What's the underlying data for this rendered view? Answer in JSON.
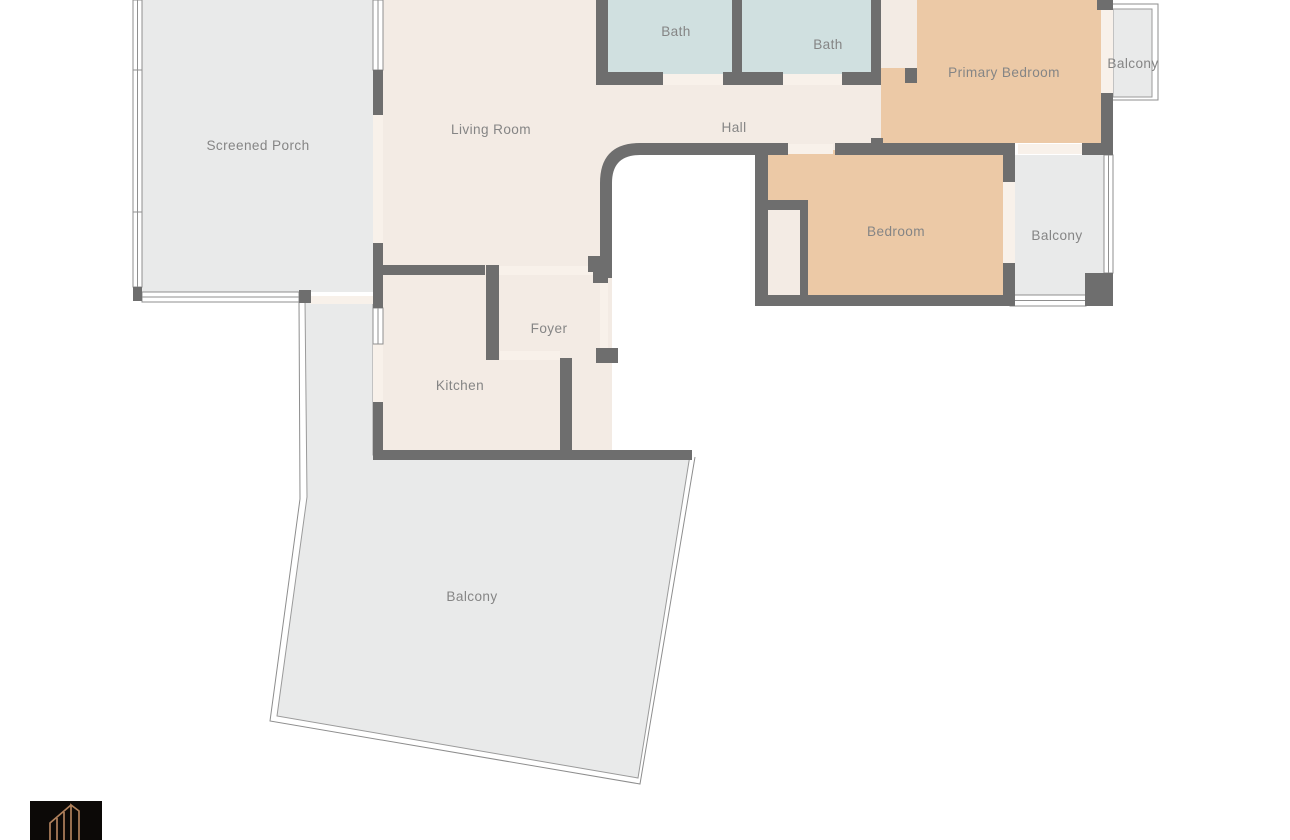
{
  "title": "Floor plan",
  "rooms": [
    {
      "id": "screened-porch",
      "label": "Screened Porch"
    },
    {
      "id": "living-room",
      "label": "Living Room"
    },
    {
      "id": "bath-1",
      "label": "Bath"
    },
    {
      "id": "bath-2",
      "label": "Bath"
    },
    {
      "id": "primary-bedroom",
      "label": "Primary Bedroom"
    },
    {
      "id": "balcony-top",
      "label": "Balcony"
    },
    {
      "id": "hall",
      "label": "Hall"
    },
    {
      "id": "bedroom",
      "label": "Bedroom"
    },
    {
      "id": "balcony-right",
      "label": "Balcony"
    },
    {
      "id": "foyer",
      "label": "Foyer"
    },
    {
      "id": "kitchen",
      "label": "Kitchen"
    },
    {
      "id": "balcony-bottom",
      "label": "Balcony"
    }
  ],
  "colors": {
    "floor": "#f3ebe4",
    "threshold": "#f8f1ea",
    "bath": "#d0e0e0",
    "bedroom": "#ecc9a6",
    "outdoor": "#e9eaea",
    "wall": "#6e6e6e",
    "window_line": "#8f8f8f",
    "outline": "#8d8d8d",
    "label_text": "#858585",
    "logo_bg": "#0c0907",
    "logo_accent": "#b0815c"
  },
  "logo": {
    "icon": "building-outline-icon"
  }
}
